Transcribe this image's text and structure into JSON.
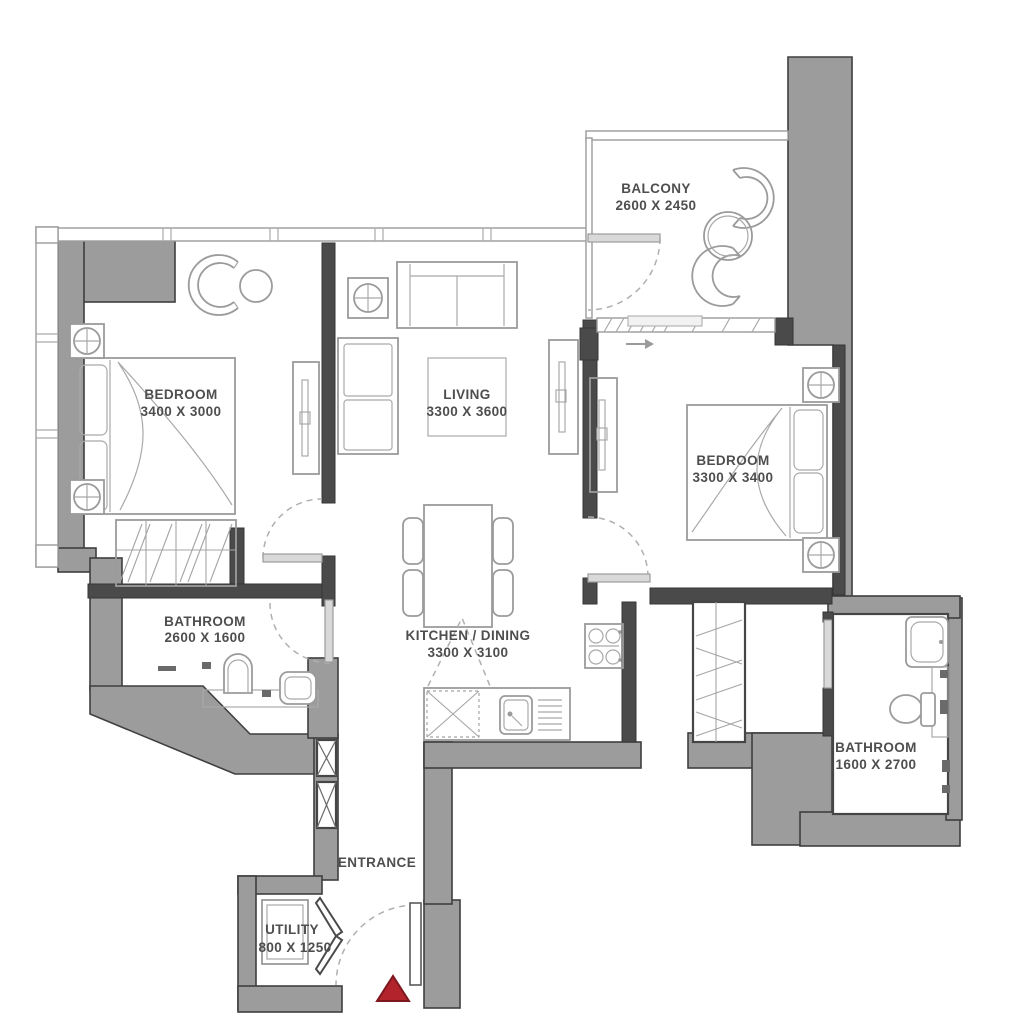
{
  "plan": {
    "type": "apartment-floor-plan",
    "rooms": {
      "balcony": {
        "name": "BALCONY",
        "dims": "2600 X 2450"
      },
      "bedroom_1": {
        "name": "BEDROOM",
        "dims": "3400 X 3000"
      },
      "living": {
        "name": "LIVING",
        "dims": "3300 X 3600"
      },
      "bedroom_2": {
        "name": "BEDROOM",
        "dims": "3300 X 3400"
      },
      "bathroom_1": {
        "name": "BATHROOM",
        "dims": "2600 X 1600"
      },
      "kitchen_dining": {
        "name": "KITCHEN / DINING",
        "dims": "3300 X 3100"
      },
      "bathroom_2": {
        "name": "BATHROOM",
        "dims": "1600 X 2700"
      },
      "entrance": {
        "name": "ENTRANCE"
      },
      "utility": {
        "name": "UTILITY",
        "dims": "800 X 1250"
      }
    },
    "markers": {
      "entrance_marker": "red-triangle"
    },
    "colors": {
      "wall_fill": "#9c9c9c",
      "wall_dark": "#4a4a4a",
      "furniture_line": "#9b9b9b",
      "label_text": "#4e4e4e",
      "entrance_marker_red": "#b3232b",
      "background": "#ffffff"
    }
  }
}
